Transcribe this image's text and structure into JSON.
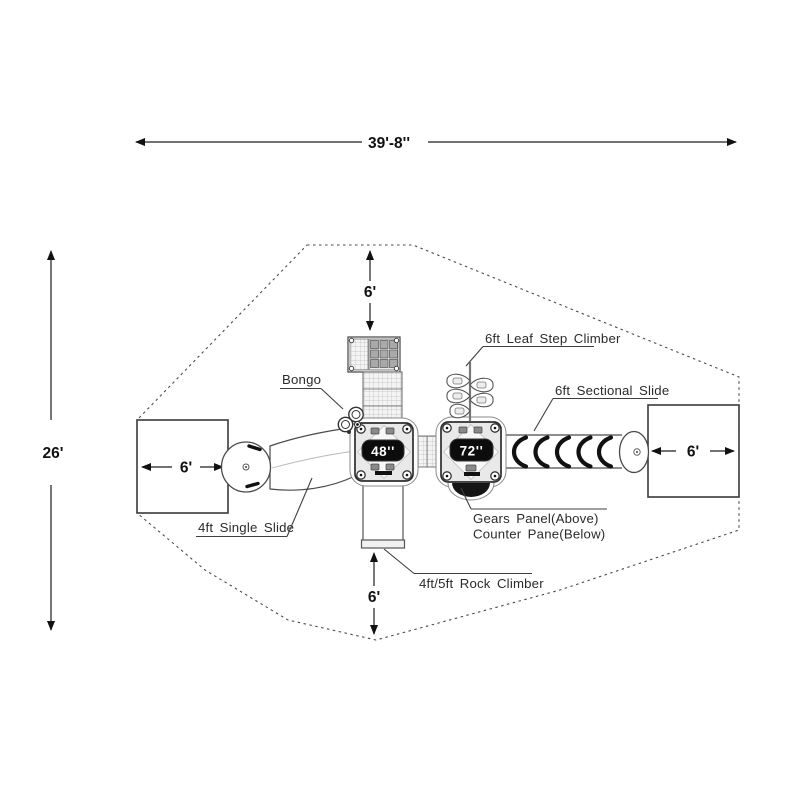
{
  "diagram": {
    "type": "playground-structure-plan-top-view",
    "dimensions": {
      "overall_width": "39'-8''",
      "overall_depth": "26'",
      "top_use_zone": "6'",
      "bottom_use_zone": "6'",
      "left_exit_zone": "6'",
      "right_exit_zone": "6'"
    },
    "decks": {
      "left_deck_height": "48''",
      "right_deck_height": "72''"
    },
    "components": {
      "bongo": "Bongo",
      "leaf_step_climber": "6ft Leaf Step Climber",
      "sectional_slide": "6ft Sectional Slide",
      "single_slide": "4ft Single Slide",
      "gears_panel_line1": "Gears Panel(Above)",
      "gears_panel_line2": "Counter Pane(Below)",
      "rock_climber": "4ft/5ft Rock Climber"
    },
    "colors": {
      "line": "#2c2c2c",
      "deck_fill": "#e9e9e9",
      "panel_bg": "#0c0c0c",
      "panel_text": "#ffffff",
      "boundary": "#4a4a4a"
    }
  }
}
